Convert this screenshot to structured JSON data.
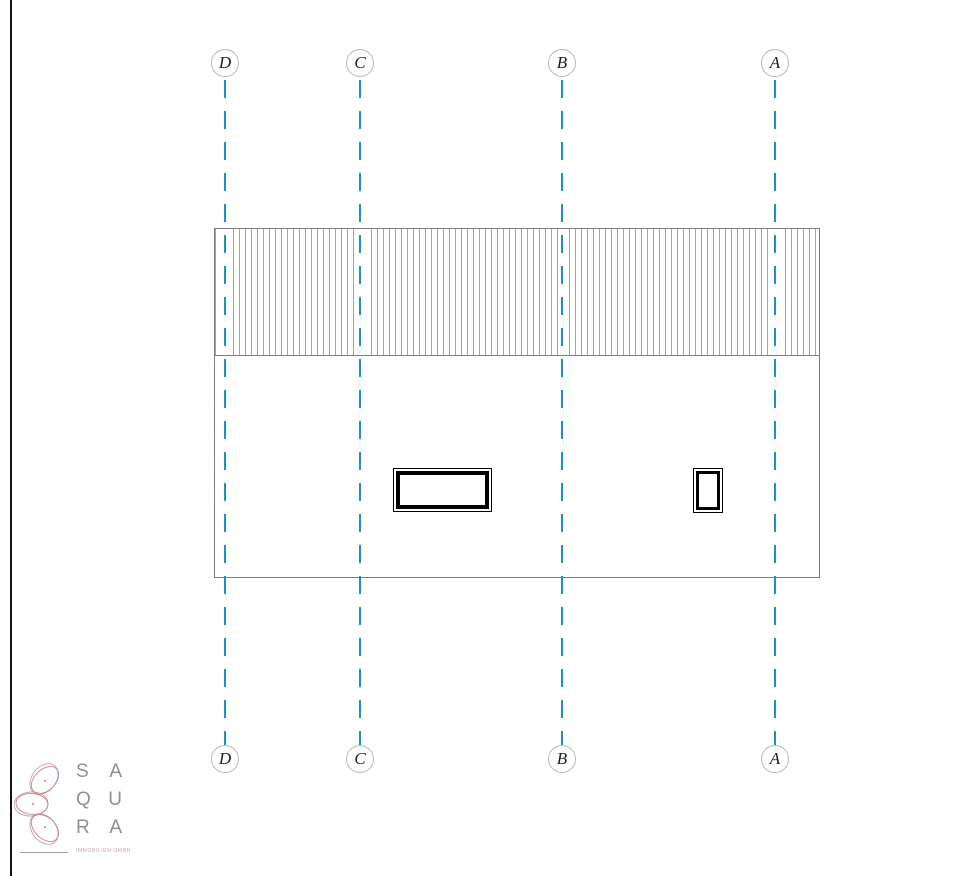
{
  "drawing": {
    "grid_marks": [
      {
        "label": "D"
      },
      {
        "label": "C"
      },
      {
        "label": "B"
      },
      {
        "label": "A"
      }
    ],
    "colors": {
      "grid_line": "#1b8fd0",
      "outline": "#7d7d7d",
      "hatch": "#a3a3a3",
      "window_frame": "#000000"
    }
  },
  "logo": {
    "rows": [
      {
        "left": "S",
        "right": "A"
      },
      {
        "left": "Q",
        "right": "U"
      },
      {
        "left": "R",
        "right": "A"
      }
    ],
    "tagline": "IMMOBILIEN GMBH",
    "colors": {
      "flower": "#cf9aa4",
      "text": "#8b9196",
      "tagline": "#c9a3a8"
    }
  }
}
